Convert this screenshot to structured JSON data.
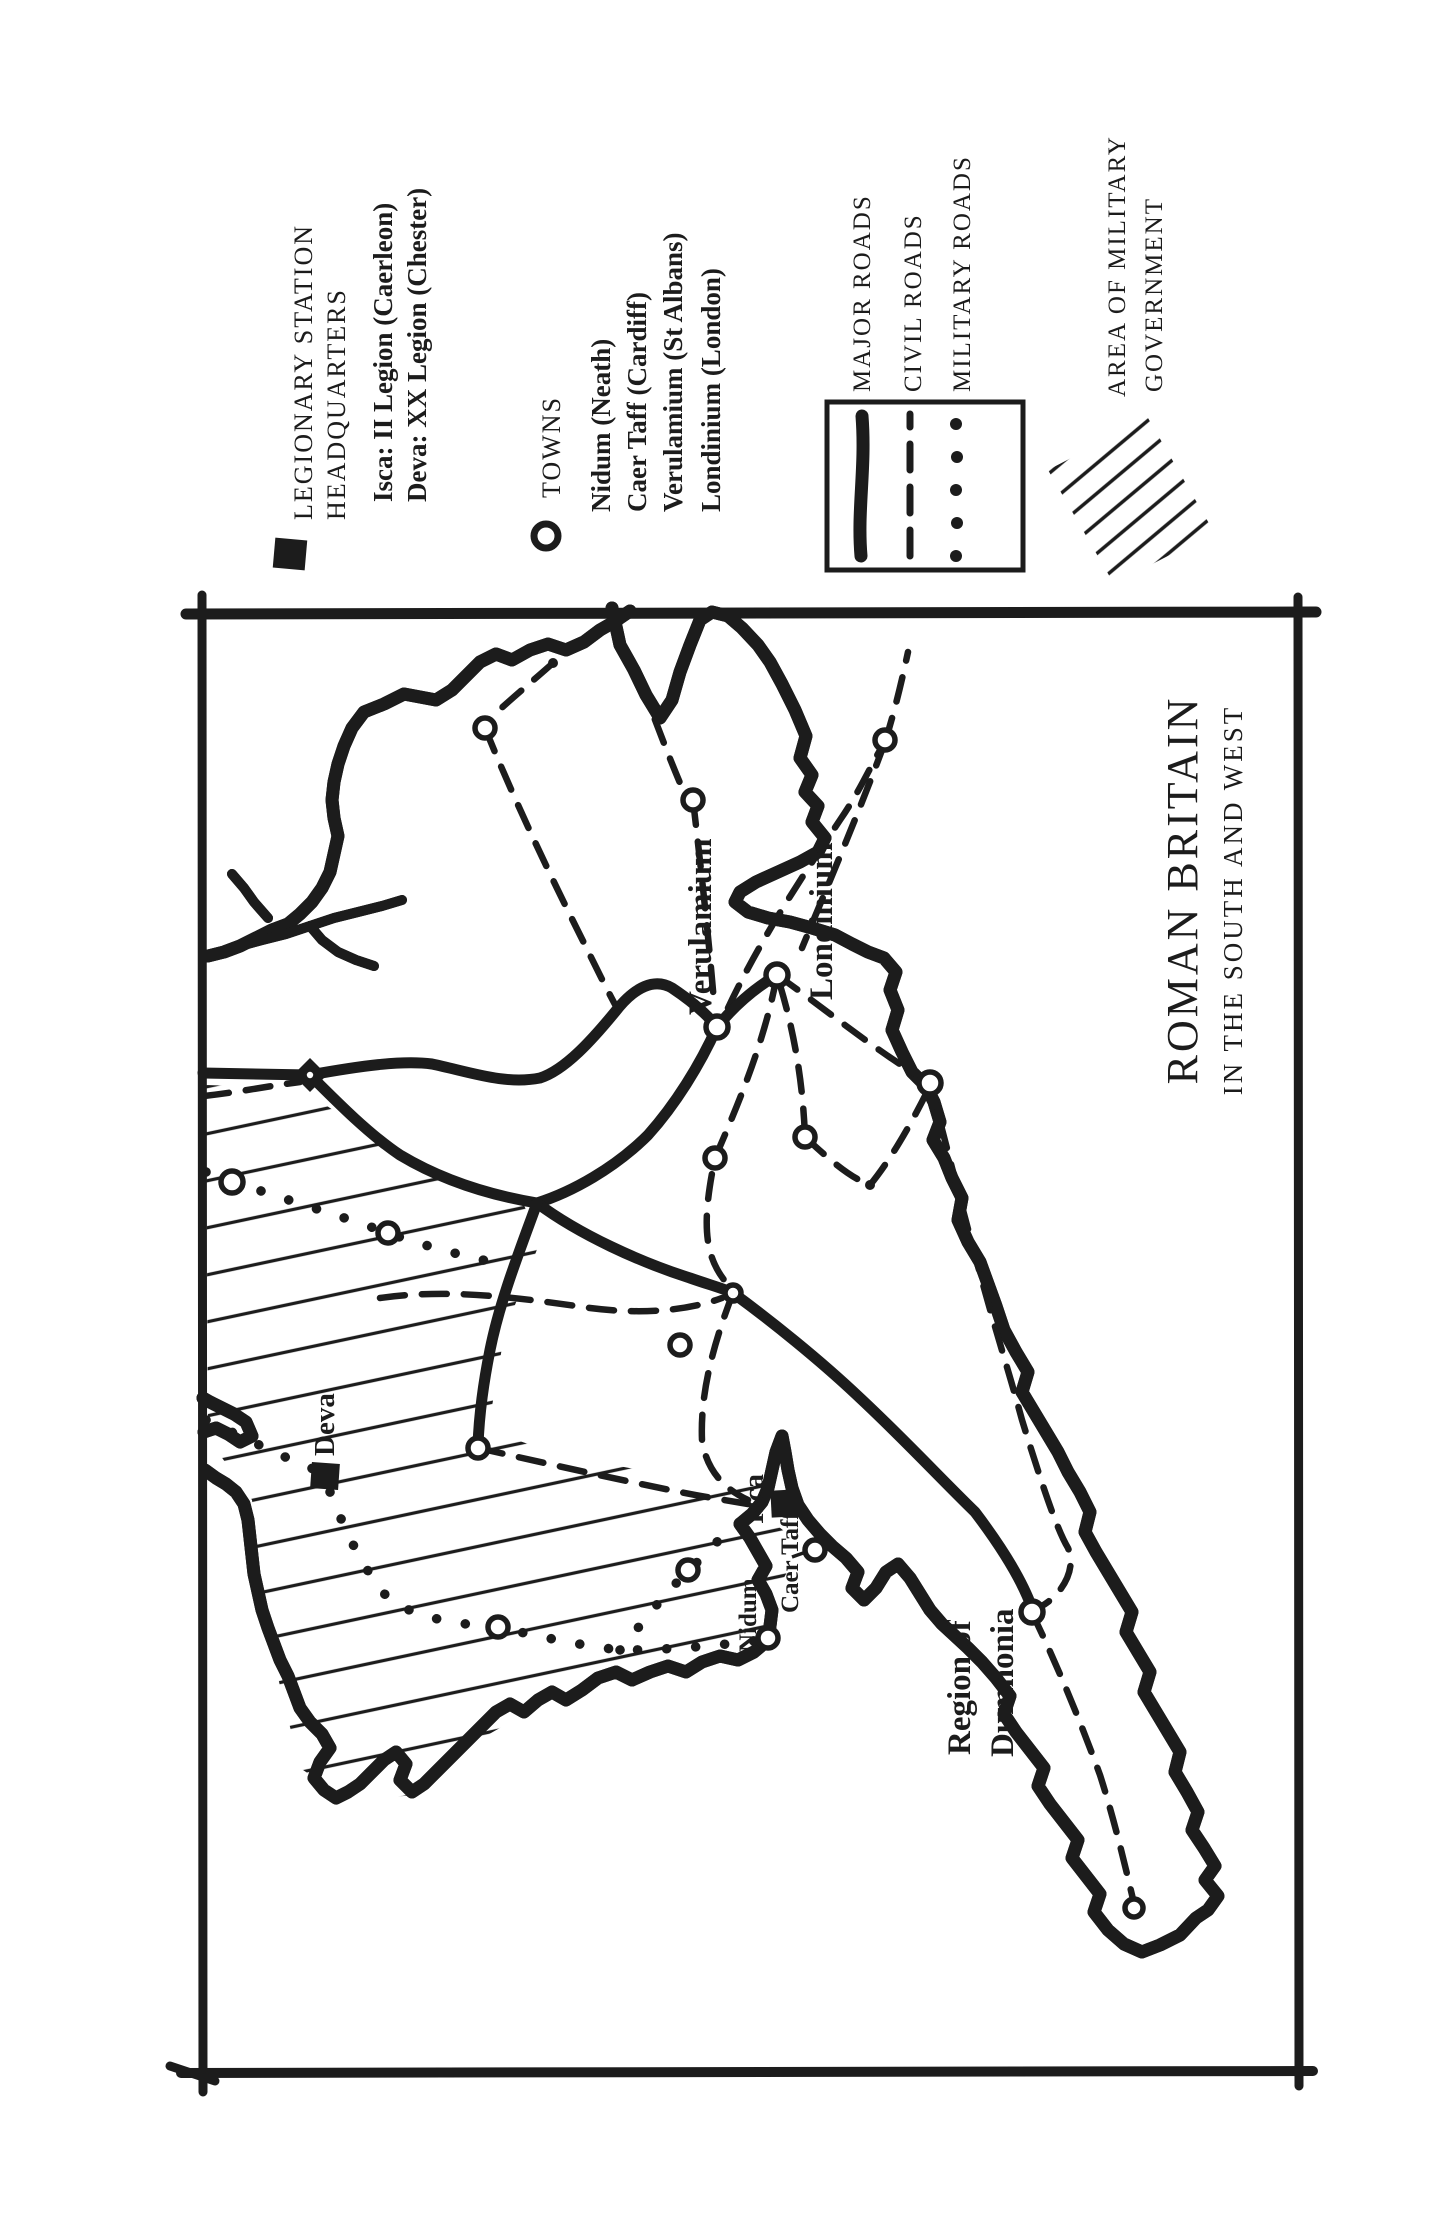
{
  "figure": {
    "ink": "#1c1c1c",
    "paper": "#ffffff"
  },
  "legend": {
    "legionary": {
      "marker": "filled-square-icon",
      "title_line1": "LEGIONARY STATION",
      "title_line2": "HEADQUARTERS",
      "entries": [
        "Isca: II Legion (Caerleon)",
        "Deva: XX Legion (Chester)"
      ]
    },
    "towns": {
      "marker": "open-circle-icon",
      "title": "TOWNS",
      "entries": [
        "Nidum (Neath)",
        "Caer Taff (Cardiff)",
        "Verulamium (St Albans)",
        "Londinium (London)"
      ]
    },
    "roads": {
      "items": [
        {
          "label": "MAJOR ROADS",
          "style": "solid-thick"
        },
        {
          "label": "CIVIL ROADS",
          "style": "dashed"
        },
        {
          "label": "MILITARY ROADS",
          "style": "dotted"
        }
      ]
    },
    "military_area": {
      "label_line1": "AREA OF MILITARY",
      "label_line2": "GOVERNMENT",
      "style": "diagonal-hatch"
    }
  },
  "map": {
    "title": "ROMAN BRITAIN",
    "subtitle": "IN THE SOUTH AND WEST",
    "labels": {
      "verulamium": "Verulamium",
      "londinium": "Londinium",
      "deva": "Deva",
      "isca": "Isca",
      "caer_taff": "Caer Taff",
      "nidum": "Nidum",
      "dumnonia_line1": "Region of",
      "dumnonia_line2": "Dumnonia"
    }
  }
}
